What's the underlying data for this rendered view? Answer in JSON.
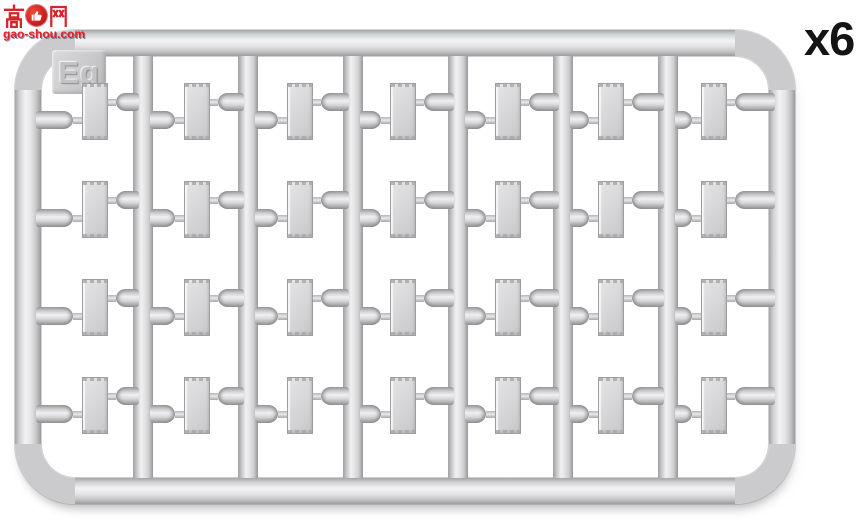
{
  "quantity_label": "x6",
  "watermark": {
    "char_left": "高",
    "char_right": "网",
    "site_url": "gao-shou.com",
    "brand_color": "#d8232a"
  },
  "sprue": {
    "code_label": "Eg",
    "columns": 7,
    "rows": 4,
    "parts_total": 28,
    "plastic_color": "#d6d6d8",
    "layout": {
      "runner_x": [
        143,
        248,
        353,
        458,
        563,
        668
      ],
      "runner_w": 20,
      "runner_top": 44,
      "runner_bottom": 486,
      "row_y": [
        83,
        181,
        279,
        377
      ],
      "plate_x": [
        82,
        184,
        287,
        390,
        495,
        598,
        701
      ],
      "plate_w": 26,
      "plate_h": 57,
      "arm_left_x": [
        36,
        150,
        255,
        360,
        465,
        570,
        675
      ],
      "arm_right_end": [
        139,
        244,
        349,
        454,
        559,
        664,
        775
      ]
    }
  }
}
